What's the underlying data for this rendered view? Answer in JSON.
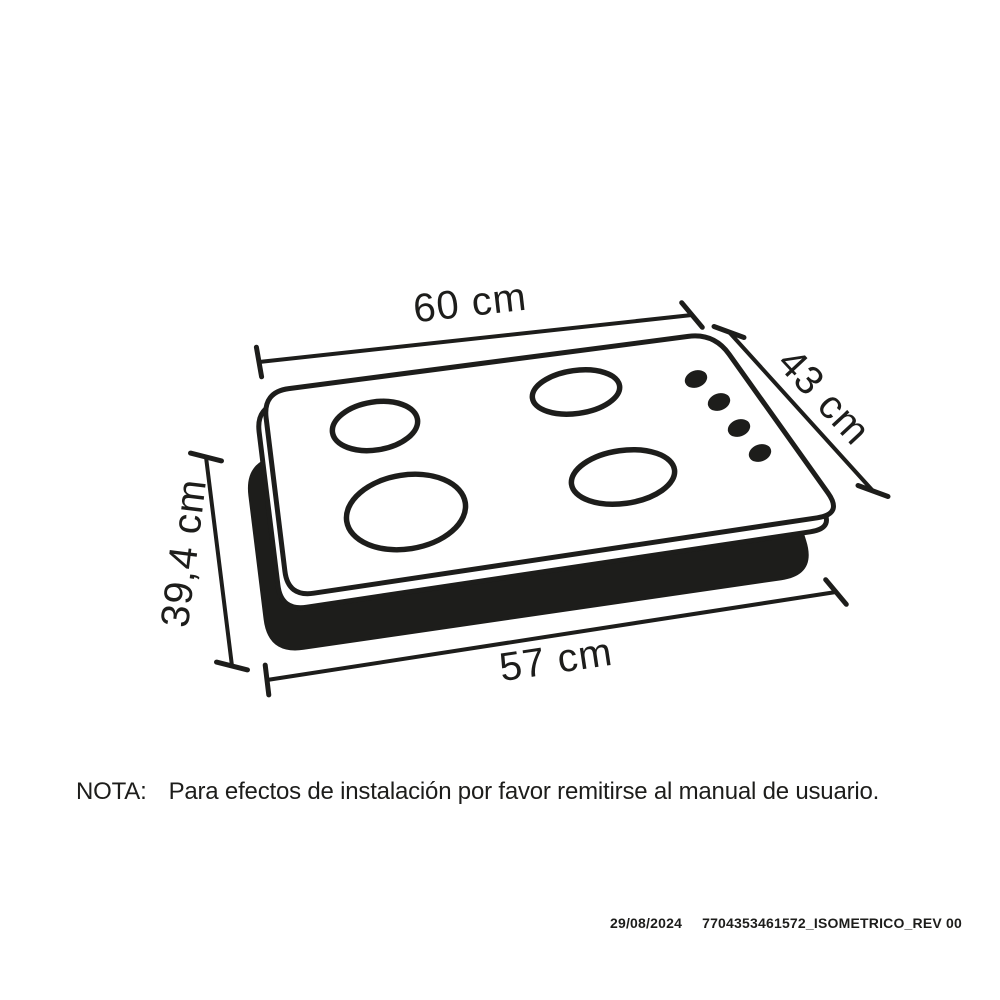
{
  "diagram": {
    "figure": {
      "kind": "cooktop-isometric-view",
      "burner_count": 4,
      "knob_count": 4
    },
    "colors": {
      "ink": "#1d1d1b",
      "background": "#ffffff"
    },
    "dimensions": {
      "top_width": "60 cm",
      "right_depth": "43 cm",
      "left_cutout_depth": "39,4 cm",
      "bottom_cutout_width": "57 cm"
    }
  },
  "note": {
    "label": "NOTA:",
    "text": "Para efectos de instalación por favor remitirse al manual de usuario."
  },
  "footer": {
    "date": "29/08/2024",
    "document_id": "7704353461572_ISOMETRICO_REV 00"
  }
}
